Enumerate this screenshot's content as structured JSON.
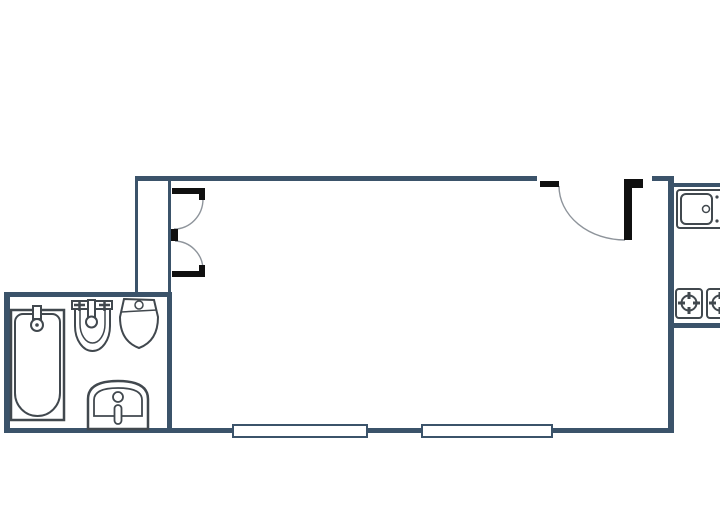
{
  "meta": {
    "type": "floor-plan",
    "canvas_width": 720,
    "canvas_height": 532
  },
  "palette": {
    "background": "#ffffff",
    "wall": "#3b536a",
    "fixture": "#41484e",
    "door": "#101010",
    "arc": "#8e949b",
    "white": "#ffffff",
    "none": "none"
  },
  "floor_plan": {
    "rooms": [
      "main-room",
      "bathroom",
      "entry-closet",
      "kitchen"
    ],
    "shapes": [
      {
        "name": "top-wall-left",
        "type": "rect",
        "attrs": {
          "x": 135,
          "y": 176,
          "width": 402,
          "height": 5
        },
        "fill": "wall"
      },
      {
        "name": "top-wall-right-stub",
        "type": "rect",
        "attrs": {
          "x": 652,
          "y": 176,
          "width": 20,
          "height": 5
        },
        "fill": "wall"
      },
      {
        "name": "right-wall",
        "type": "rect",
        "attrs": {
          "x": 668,
          "y": 176,
          "width": 6,
          "height": 257
        },
        "fill": "wall"
      },
      {
        "name": "bottom-wall",
        "type": "rect",
        "attrs": {
          "x": 7,
          "y": 428,
          "width": 667,
          "height": 5
        },
        "fill": "wall"
      },
      {
        "name": "bathroom-left-wall",
        "type": "rect",
        "attrs": {
          "x": 4,
          "y": 292,
          "width": 6,
          "height": 141
        },
        "fill": "wall"
      },
      {
        "name": "bathroom-top-wall",
        "type": "rect",
        "attrs": {
          "x": 4,
          "y": 292,
          "width": 168,
          "height": 5
        },
        "fill": "wall"
      },
      {
        "name": "bathroom-right-wall",
        "type": "rect",
        "attrs": {
          "x": 167,
          "y": 292,
          "width": 5,
          "height": 141
        },
        "fill": "wall"
      },
      {
        "name": "entry-closet-outer-line",
        "type": "rect",
        "attrs": {
          "x": 135,
          "y": 181,
          "width": 3,
          "height": 111
        },
        "fill": "wall"
      },
      {
        "name": "entry-closet-inner-line",
        "type": "rect",
        "attrs": {
          "x": 168,
          "y": 181,
          "width": 3,
          "height": 111
        },
        "fill": "wall"
      },
      {
        "name": "kitchen-top-wall",
        "type": "rect",
        "attrs": {
          "x": 672,
          "y": 183,
          "width": 48,
          "height": 4
        },
        "fill": "wall"
      },
      {
        "name": "kitchen-bottom-wall",
        "type": "rect",
        "attrs": {
          "x": 672,
          "y": 323,
          "width": 48,
          "height": 5
        },
        "fill": "wall"
      },
      {
        "name": "window-1",
        "type": "rect",
        "attrs": {
          "x": 233,
          "y": 425,
          "width": 134,
          "height": 12
        },
        "fill": "white",
        "stroke": "wall",
        "stroke_width": 2
      },
      {
        "name": "window-2",
        "type": "rect",
        "attrs": {
          "x": 422,
          "y": 425,
          "width": 130,
          "height": 12
        },
        "fill": "white",
        "stroke": "wall",
        "stroke_width": 2
      },
      {
        "name": "entry-door-top-swing-arc",
        "type": "path",
        "attrs": {
          "d": "M203,199 A29,30 0 0 1 174,229"
        },
        "fill": "none",
        "stroke": "arc",
        "stroke_width": 1.4
      },
      {
        "name": "entry-door-bottom-swing-arc",
        "type": "path",
        "attrs": {
          "d": "M175,241 A29,29 0 0 1 203,269"
        },
        "fill": "none",
        "stroke": "arc",
        "stroke_width": 1.4
      },
      {
        "name": "main-door-swing-arc",
        "type": "path",
        "attrs": {
          "d": "M559,186 A66,54 0 0 0 625,240"
        },
        "fill": "none",
        "stroke": "arc",
        "stroke_width": 1.4
      },
      {
        "name": "entry-door-top-jamb",
        "type": "rect",
        "attrs": {
          "x": 172,
          "y": 188,
          "width": 33,
          "height": 6
        },
        "fill": "door"
      },
      {
        "name": "entry-door-top-jamb-tick",
        "type": "rect",
        "attrs": {
          "x": 199,
          "y": 194,
          "width": 6,
          "height": 6
        },
        "fill": "door"
      },
      {
        "name": "entry-door-middle-post",
        "type": "rect",
        "attrs": {
          "x": 171,
          "y": 229,
          "width": 7,
          "height": 12
        },
        "fill": "door"
      },
      {
        "name": "entry-door-bottom-jamb",
        "type": "rect",
        "attrs": {
          "x": 172,
          "y": 271,
          "width": 33,
          "height": 6
        },
        "fill": "door"
      },
      {
        "name": "entry-door-bottom-jamb-tick",
        "type": "rect",
        "attrs": {
          "x": 199,
          "y": 265,
          "width": 6,
          "height": 6
        },
        "fill": "door"
      },
      {
        "name": "main-door-left-jamb",
        "type": "rect",
        "attrs": {
          "x": 540,
          "y": 181,
          "width": 19,
          "height": 6
        },
        "fill": "door"
      },
      {
        "name": "main-door-leaf-top",
        "type": "rect",
        "attrs": {
          "x": 624,
          "y": 179,
          "width": 19,
          "height": 9
        },
        "fill": "door"
      },
      {
        "name": "main-door-leaf",
        "type": "rect",
        "attrs": {
          "x": 624,
          "y": 179,
          "width": 8,
          "height": 61
        },
        "fill": "door"
      },
      {
        "name": "bathtub-surround",
        "type": "rect",
        "attrs": {
          "x": 11,
          "y": 310,
          "width": 53,
          "height": 110
        },
        "fill": "white",
        "stroke": "fixture",
        "stroke_width": 2.5
      },
      {
        "name": "bathtub-basin",
        "type": "path",
        "attrs": {
          "d": "M23,314 h29 a8,8 0 0 1 8,8 v71 a22.5,23 0 0 1 -45,0 v-71 a8,8 0 0 1 8,-8 z"
        },
        "fill": "white",
        "stroke": "fixture",
        "stroke_width": 2
      },
      {
        "name": "bathtub-faucet",
        "type": "rect",
        "attrs": {
          "x": 33,
          "y": 306,
          "width": 8,
          "height": 13
        },
        "fill": "white",
        "stroke": "fixture",
        "stroke_width": 2
      },
      {
        "name": "bathtub-drain-circle",
        "type": "circle",
        "attrs": {
          "cx": 37,
          "cy": 325,
          "r": 6
        },
        "fill": "white",
        "stroke": "fixture",
        "stroke_width": 2
      },
      {
        "name": "bathtub-drain-dot",
        "type": "circle",
        "attrs": {
          "cx": 37,
          "cy": 325,
          "r": 1.8
        },
        "fill": "fixture"
      },
      {
        "name": "washbasin-ledge",
        "type": "rect",
        "attrs": {
          "x": 72,
          "y": 301,
          "width": 40,
          "height": 8
        },
        "fill": "white",
        "stroke": "fixture",
        "stroke_width": 2
      },
      {
        "name": "washbasin-bowl-outer",
        "type": "path",
        "attrs": {
          "d": "M75,309 v17 a17.5,25 0 0 0 35,0 v-17 z"
        },
        "fill": "white",
        "stroke": "fixture",
        "stroke_width": 2
      },
      {
        "name": "washbasin-bowl-inner",
        "type": "path",
        "attrs": {
          "d": "M80,309 v15 a12.5,19 0 0 0 25,0 v-15"
        },
        "fill": "none",
        "stroke": "fixture",
        "stroke_width": 1.5
      },
      {
        "name": "washbasin-tap-cross-left",
        "type": "path",
        "attrs": {
          "d": "M74,305 h11 M79.5,300 v11"
        },
        "fill": "none",
        "stroke": "fixture",
        "stroke_width": 2.5
      },
      {
        "name": "washbasin-tap-cross-right",
        "type": "path",
        "attrs": {
          "d": "M99,305 h11 M104.5,300 v11"
        },
        "fill": "none",
        "stroke": "fixture",
        "stroke_width": 2.5
      },
      {
        "name": "washbasin-faucet-stem",
        "type": "rect",
        "attrs": {
          "x": 88,
          "y": 300,
          "width": 7,
          "height": 18
        },
        "fill": "white",
        "stroke": "fixture",
        "stroke_width": 2
      },
      {
        "name": "washbasin-faucet-circle",
        "type": "circle",
        "attrs": {
          "cx": 91.5,
          "cy": 322,
          "r": 5.5
        },
        "fill": "white",
        "stroke": "fixture",
        "stroke_width": 2
      },
      {
        "name": "toilet-body",
        "type": "path",
        "attrs": {
          "d": "M124,299 L154,300 L158,317 Q158,341 139,348 Q120,341 120,317 Z"
        },
        "fill": "white",
        "stroke": "fixture",
        "stroke_width": 2
      },
      {
        "name": "toilet-bowl-line",
        "type": "path",
        "attrs": {
          "d": "M121,312 L157,310"
        },
        "fill": "none",
        "stroke": "fixture",
        "stroke_width": 1.5
      },
      {
        "name": "toilet-flush-button",
        "type": "circle",
        "attrs": {
          "cx": 139,
          "cy": 305,
          "r": 4
        },
        "fill": "white",
        "stroke": "fixture",
        "stroke_width": 1.5
      },
      {
        "name": "pedestal-basin-outer",
        "type": "path",
        "attrs": {
          "d": "M88,429 V399 Q88,381 118,381 Q148,381 148,399 V429 Z"
        },
        "fill": "white",
        "stroke": "fixture",
        "stroke_width": 2.5
      },
      {
        "name": "pedestal-basin-inner",
        "type": "path",
        "attrs": {
          "d": "M94,416 V400 Q94,388 118,388 Q142,388 142,400 V416 Z"
        },
        "fill": "none",
        "stroke": "fixture",
        "stroke_width": 1.8
      },
      {
        "name": "pedestal-basin-circle",
        "type": "circle",
        "attrs": {
          "cx": 118,
          "cy": 397,
          "r": 5
        },
        "fill": "white",
        "stroke": "fixture",
        "stroke_width": 1.8
      },
      {
        "name": "pedestal-basin-slot",
        "type": "rect",
        "attrs": {
          "x": 114.5,
          "y": 405,
          "width": 7,
          "height": 19,
          "rx": 3.5
        },
        "fill": "white",
        "stroke": "fixture",
        "stroke_width": 1.8
      },
      {
        "name": "kitchen-sink-counter",
        "type": "rect",
        "attrs": {
          "x": 677,
          "y": 190,
          "width": 50,
          "height": 38,
          "rx": 3
        },
        "fill": "white",
        "stroke": "fixture",
        "stroke_width": 2
      },
      {
        "name": "kitchen-sink-basin",
        "type": "rect",
        "attrs": {
          "x": 681,
          "y": 194,
          "width": 31,
          "height": 30,
          "rx": 5
        },
        "fill": "white",
        "stroke": "fixture",
        "stroke_width": 2
      },
      {
        "name": "kitchen-sink-drain",
        "type": "circle",
        "attrs": {
          "cx": 706,
          "cy": 209,
          "r": 3.5
        },
        "fill": "white",
        "stroke": "fixture",
        "stroke_width": 1.5
      },
      {
        "name": "kitchen-sink-dot-top",
        "type": "circle",
        "attrs": {
          "cx": 717,
          "cy": 197,
          "r": 1.6
        },
        "fill": "fixture"
      },
      {
        "name": "kitchen-sink-dot-bottom",
        "type": "circle",
        "attrs": {
          "cx": 717,
          "cy": 221,
          "r": 1.6
        },
        "fill": "fixture"
      },
      {
        "name": "stove-module-left",
        "type": "rect",
        "attrs": {
          "x": 676,
          "y": 289,
          "width": 26,
          "height": 29,
          "rx": 3
        },
        "fill": "white",
        "stroke": "fixture",
        "stroke_width": 2
      },
      {
        "name": "stove-module-right",
        "type": "rect",
        "attrs": {
          "x": 707,
          "y": 289,
          "width": 26,
          "height": 29,
          "rx": 3
        },
        "fill": "white",
        "stroke": "fixture",
        "stroke_width": 2
      },
      {
        "name": "burner-left-circle",
        "type": "circle",
        "attrs": {
          "cx": 689,
          "cy": 303,
          "r": 7.5
        },
        "fill": "none",
        "stroke": "fixture",
        "stroke_width": 2
      },
      {
        "name": "burner-left-ticks",
        "type": "path",
        "attrs": {
          "d": "M689,292 V299 M689,307 V314 M678,303 H685 M693,303 H700"
        },
        "fill": "none",
        "stroke": "fixture",
        "stroke_width": 3
      },
      {
        "name": "burner-right-circle",
        "type": "circle",
        "attrs": {
          "cx": 720,
          "cy": 303,
          "r": 7.5
        },
        "fill": "none",
        "stroke": "fixture",
        "stroke_width": 2
      },
      {
        "name": "burner-right-ticks",
        "type": "path",
        "attrs": {
          "d": "M720,292 V299 M720,307 V314 M709,303 H716 M724,303 H731"
        },
        "fill": "none",
        "stroke": "fixture",
        "stroke_width": 3
      }
    ]
  }
}
